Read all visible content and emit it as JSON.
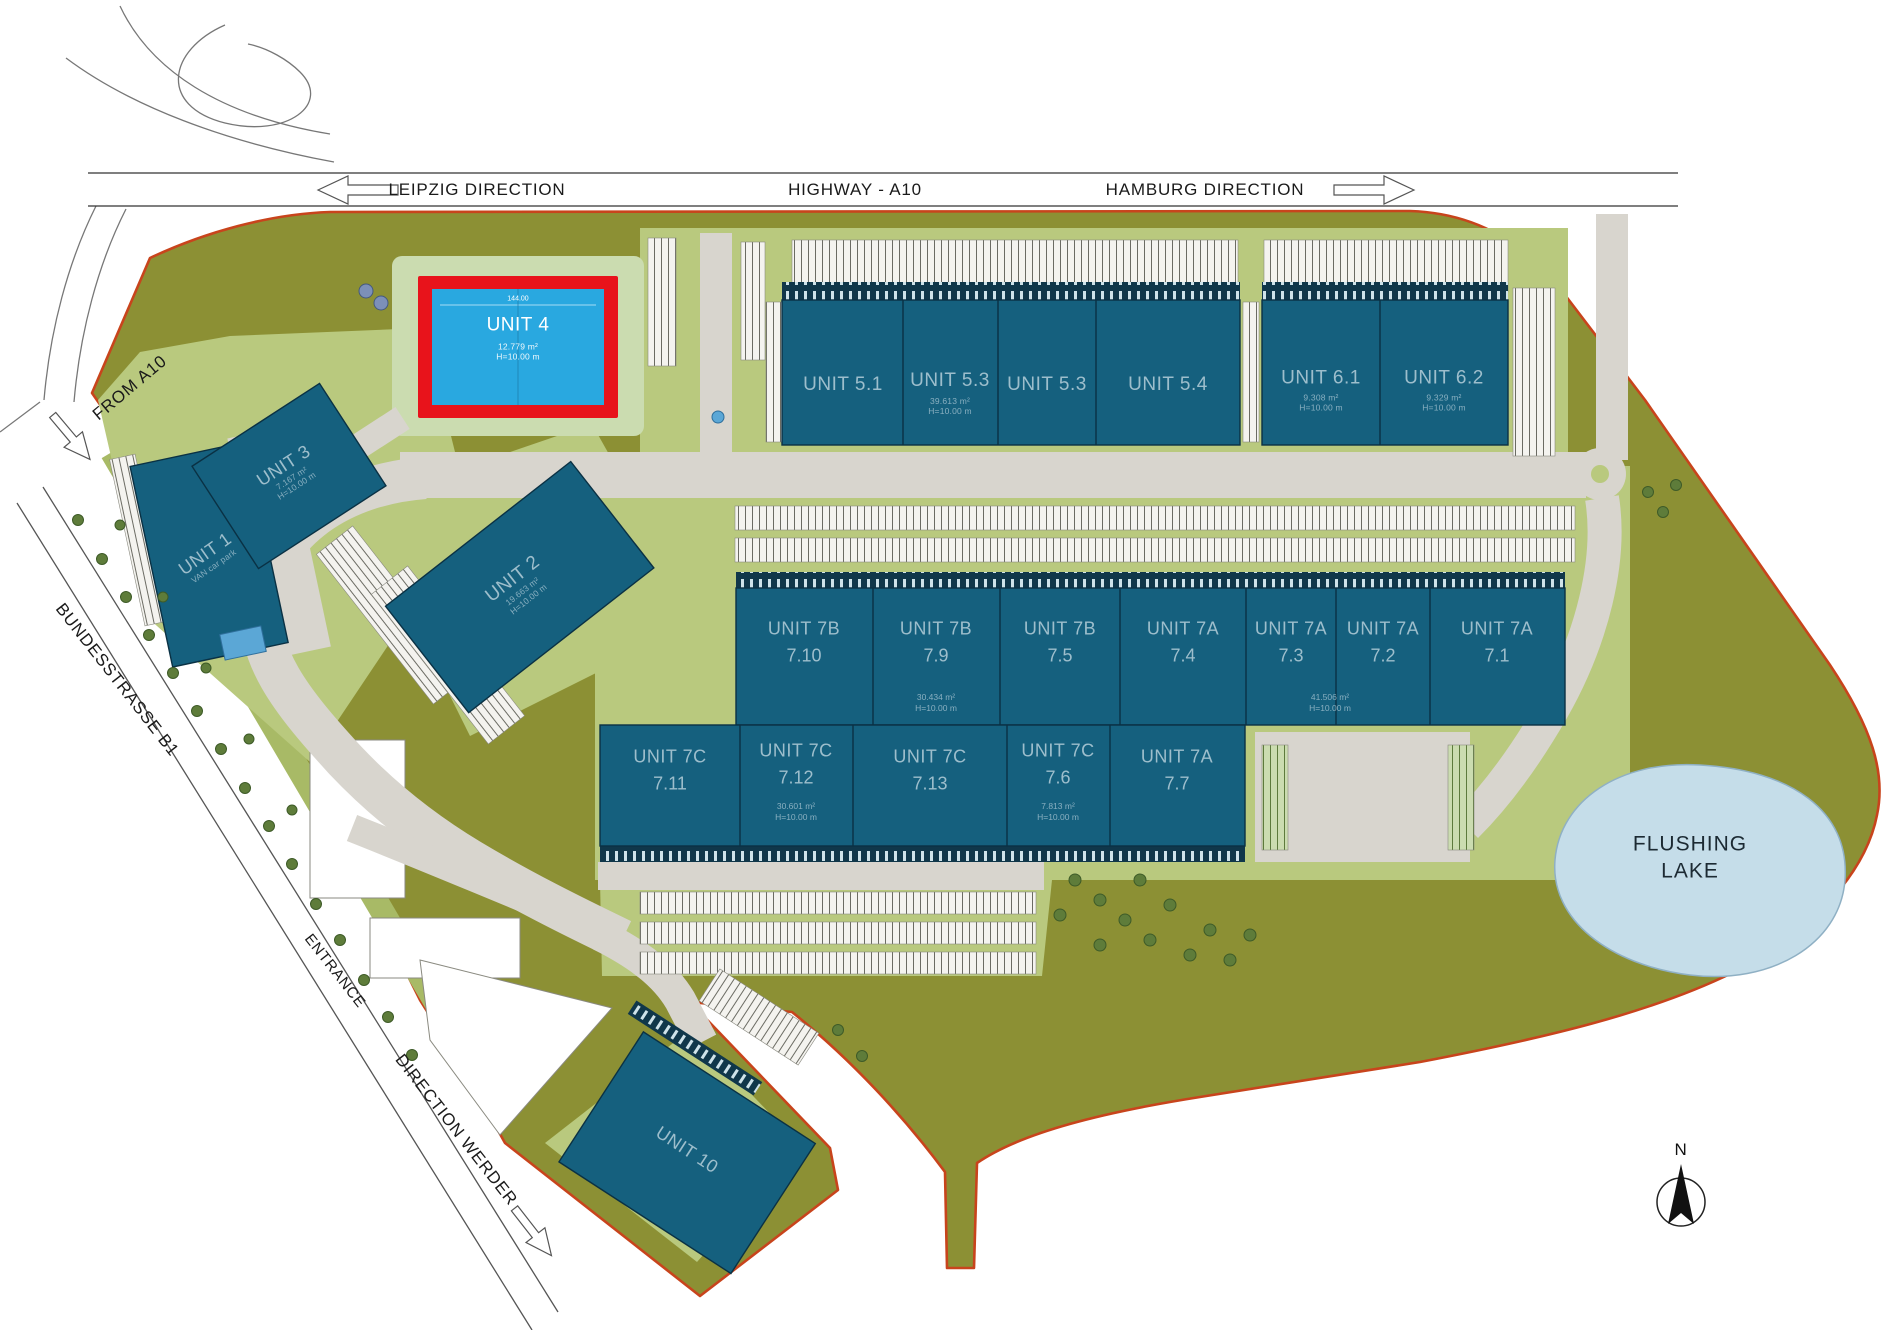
{
  "map": {
    "highway": {
      "label": "HIGHWAY - A10",
      "left_direction": "LEIPZIG DIRECTION",
      "right_direction": "HAMBURG DIRECTION"
    },
    "roads": {
      "from_a10": "FROM A10",
      "bundesstrasse": "BUNDESSTRASSE B1",
      "entrance": "ENTRANCE",
      "direction_werder": "DIRECTION WERDER"
    },
    "lake": {
      "line1": "FLUSHING",
      "line2": "LAKE"
    },
    "compass": {
      "north": "N"
    }
  },
  "units": {
    "u4": {
      "name": "UNIT 4",
      "area": "12.779 m²",
      "height": "H=10.00 m",
      "dim": "144.00"
    },
    "u1": {
      "name": "UNIT 1",
      "sub": "VAN car park"
    },
    "u2": {
      "name": "UNIT 2",
      "area": "19.663 m²",
      "height": "H=10.00 m"
    },
    "u3": {
      "name": "UNIT 3",
      "area": "7.167 m²",
      "height": "H=10.00 m"
    },
    "u51": {
      "name": "UNIT 5.1"
    },
    "u53a": {
      "name": "UNIT 5.3",
      "area": "39.613 m²",
      "height": "H=10.00 m"
    },
    "u53b": {
      "name": "UNIT 5.3"
    },
    "u54": {
      "name": "UNIT 5.4"
    },
    "u61": {
      "name": "UNIT 6.1",
      "area": "9.308 m²",
      "height": "H=10.00 m"
    },
    "u62": {
      "name": "UNIT 6.2",
      "area": "9.329 m²",
      "height": "H=10.00 m"
    },
    "u710": {
      "name": "UNIT 7B",
      "num": "7.10"
    },
    "u79": {
      "name": "UNIT 7B",
      "num": "7.9",
      "area": "30.434 m²",
      "height": "H=10.00 m"
    },
    "u75": {
      "name": "UNIT 7B",
      "num": "7.5"
    },
    "u74": {
      "name": "UNIT 7A",
      "num": "7.4"
    },
    "u73": {
      "name": "UNIT 7A",
      "num": "7.3",
      "area": "41.506 m²",
      "height": "H=10.00 m"
    },
    "u72": {
      "name": "UNIT 7A",
      "num": "7.2"
    },
    "u71": {
      "name": "UNIT 7A",
      "num": "7.1"
    },
    "u711": {
      "name": "UNIT 7C",
      "num": "7.11"
    },
    "u712": {
      "name": "UNIT 7C",
      "num": "7.12",
      "area": "30.601 m²",
      "height": "H=10.00 m"
    },
    "u713": {
      "name": "UNIT 7C",
      "num": "7.13"
    },
    "u76": {
      "name": "UNIT 7C",
      "num": "7.6",
      "area": "7.813 m²",
      "height": "H=10.00 m"
    },
    "u77": {
      "name": "UNIT 7A",
      "num": "7.7"
    },
    "u10": {
      "name": "UNIT 10"
    }
  },
  "colors": {
    "site_olive": "#8C9034",
    "landscape_green": "#B9C97E",
    "pale_green": "#CBDCB0",
    "building_teal": "#15607E",
    "building_dark": "#0C394E",
    "unit4_fill": "#29A8E0",
    "highlight_red": "#E8131B",
    "boundary_orange": "#C8441C",
    "lake_blue": "#C5DDE9",
    "road_gray": "#D8D5CE"
  }
}
